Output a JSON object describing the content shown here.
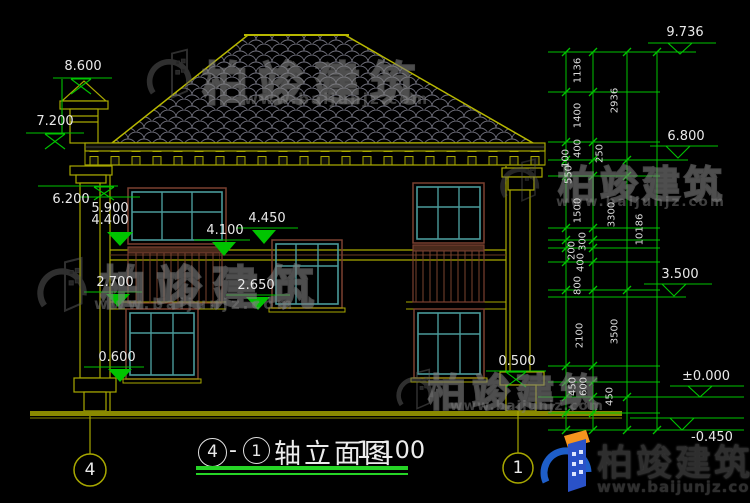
{
  "drawing": {
    "type_note": "house front elevation CAD drawing",
    "background": "#000000",
    "colors": {
      "outline_olive": "#a8a800",
      "dimension_green": "#00c400",
      "window_teal": "#4a9a9a",
      "frame_brown": "#7a4030",
      "tile_gray": "#70707c",
      "text_white": "#e9e9e9",
      "logo_blue": "#2a52c8",
      "logo_orange": "#f5941e"
    }
  },
  "elevations": {
    "left": [
      "8.600",
      "7.200",
      "6.200",
      "5.900",
      "4.400",
      "4.450",
      "4.100",
      "2.650",
      "2.700",
      "0.600",
      "0.500"
    ],
    "right": [
      "9.736",
      "6.800",
      "3.500",
      "±0.000",
      "-0.450"
    ]
  },
  "dimensions": {
    "right_inner": [
      "1136",
      "1400",
      "400",
      "100",
      "550",
      "1500",
      "300",
      "200",
      "400",
      "800",
      "2100",
      "450",
      "600",
      "450"
    ],
    "right_middle": [
      "2936",
      "250",
      "3300",
      "3500"
    ],
    "right_total": "10186"
  },
  "axis": {
    "left": "4",
    "right": "1"
  },
  "title": {
    "axis_from": "4",
    "separator": "-",
    "axis_to": "1",
    "text": "轴立面图",
    "scale": "1:100"
  },
  "brand": {
    "name": "柏竣建筑",
    "url": "www.baijunjz.com"
  }
}
